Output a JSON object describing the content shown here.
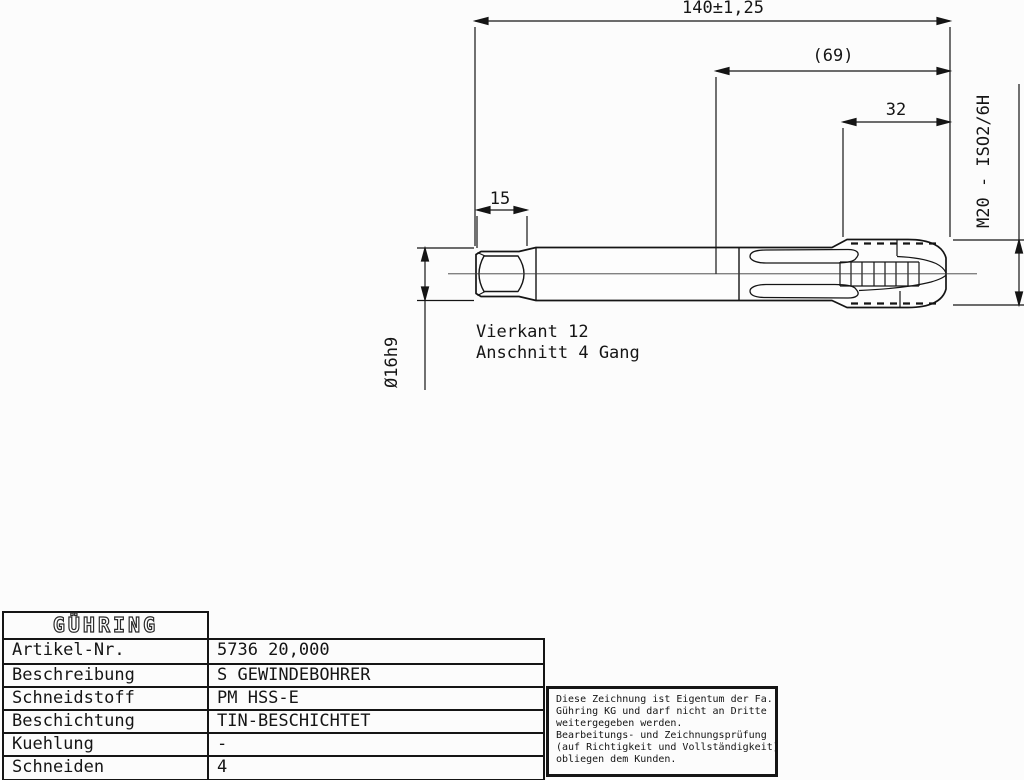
{
  "drawing": {
    "dims": {
      "overall_length": "140±1,25",
      "flute_length": "(69)",
      "thread_length": "32",
      "square_length": "15"
    },
    "labels": {
      "thread_spec": "M20 - ISO2/6H",
      "shank_diameter": "Ø16h9",
      "square_note": "Vierkant 12",
      "chamfer_note": "Anschnitt 4 Gang"
    }
  },
  "title_block": {
    "brand": "GÜHRING",
    "rows": [
      {
        "label": "Artikel-Nr.",
        "value": "5736 20,000"
      },
      {
        "label": "Beschreibung",
        "value": "S GEWINDEBOHRER"
      },
      {
        "label": "Schneidstoff",
        "value": "PM HSS-E"
      },
      {
        "label": "Beschichtung",
        "value": "TIN-BESCHICHTET"
      },
      {
        "label": "Kuehlung",
        "value": "-"
      },
      {
        "label": "Schneiden",
        "value": "4"
      }
    ]
  },
  "disclaimer": {
    "lines": [
      "Diese Zeichnung ist Eigentum der Fa.",
      "Gühring KG und darf nicht an Dritte",
      "weitergegeben werden.",
      "Bearbeitungs- und Zeichnungsprüfung",
      "(auf Richtigkeit und Vollständigkeit)",
      "obliegen dem Kunden."
    ]
  },
  "colors": {
    "ink": "#151515",
    "paper": "#fcfcfc"
  }
}
